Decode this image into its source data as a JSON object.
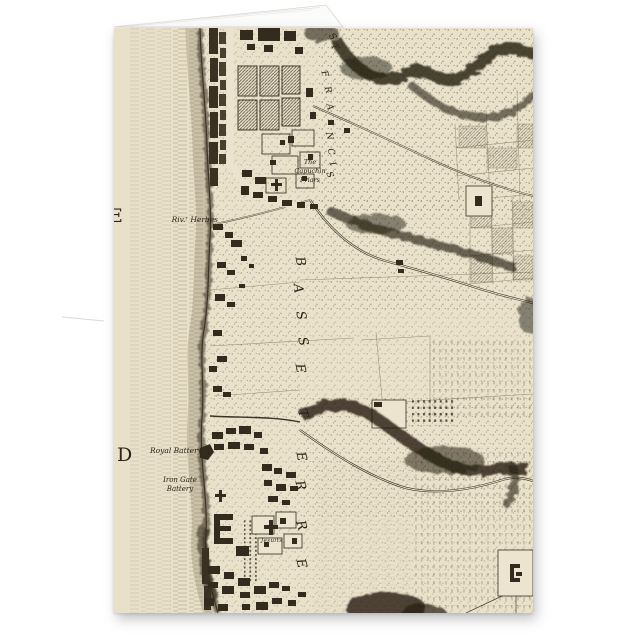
{
  "card": {
    "colors": {
      "page_bg": "#ffffff",
      "parchment": "#e8e0c9",
      "ink": "#2b2418"
    },
    "map_labels": {
      "sea_letter_top": "E",
      "sea_letter_bottom": "D",
      "river": "Riv.ʳ Herbes",
      "capuchin_line1": "The",
      "capuchin_line2": "Capuchin",
      "capuchin_line3": "Friars",
      "royal_battery": "Royal Battery",
      "iron_gate_line1": "Iron Gate",
      "iron_gate_line2": "Battery",
      "jesuits": "Jesuits",
      "district_letters": [
        "B",
        "A",
        "S",
        "S",
        "E",
        "T",
        "E",
        "R",
        "R",
        "E"
      ],
      "street_letters": [
        "S",
        "T",
        "F",
        "R",
        "A",
        "N",
        "C",
        "I",
        "S"
      ]
    }
  }
}
